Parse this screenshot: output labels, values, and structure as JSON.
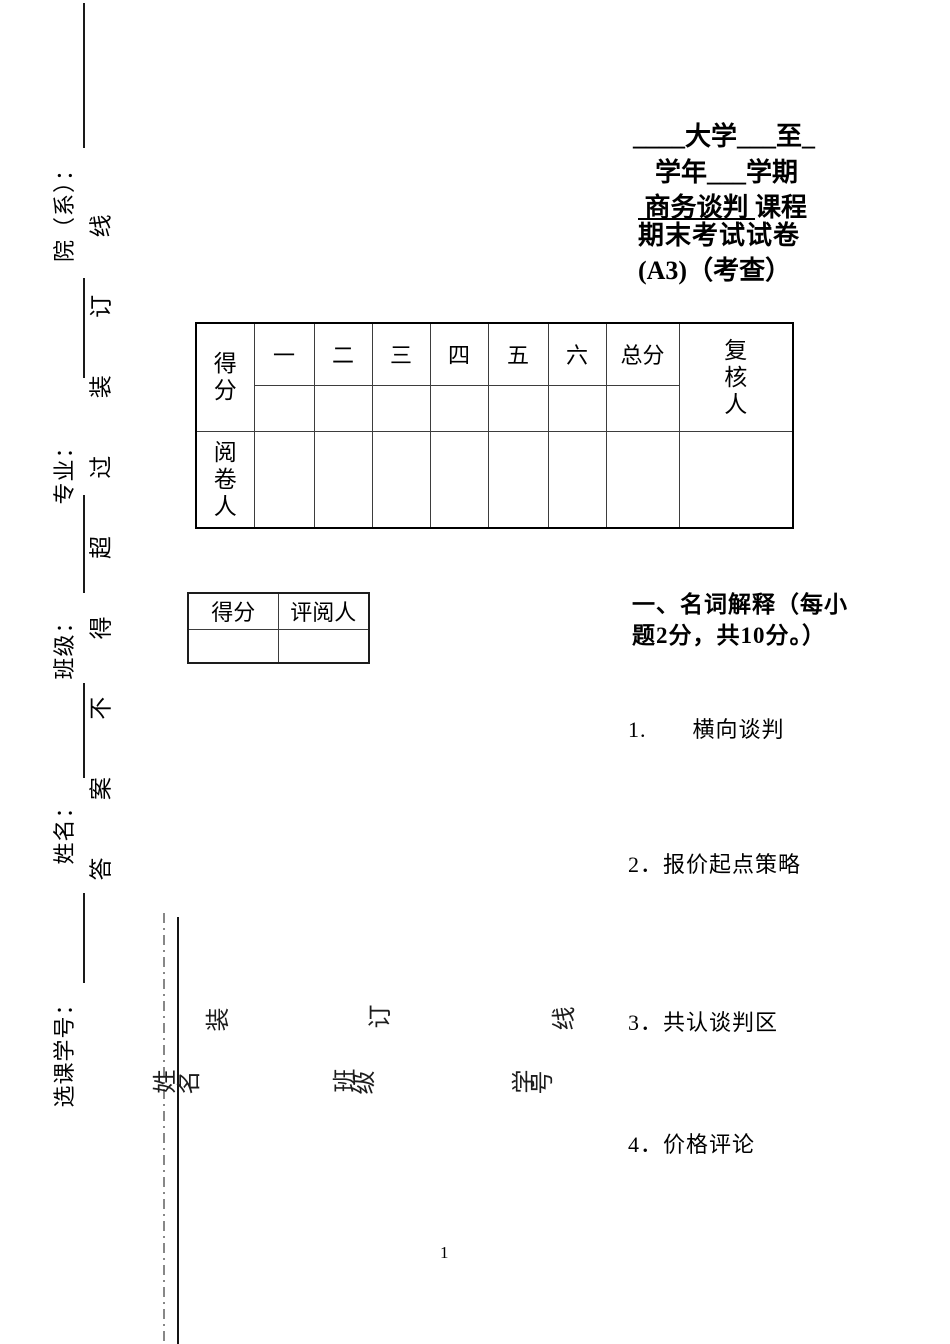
{
  "colors": {
    "text": "#000000",
    "background": "#ffffff"
  },
  "header": {
    "line1": "____大学___至_",
    "line2": "学年___学期",
    "course_name": " 商务谈判 ",
    "course_suffix": "课程",
    "line4": "期末考试试卷",
    "line5": "(A3)（考查）"
  },
  "score_table": {
    "score_label": "得分",
    "columns": [
      "一",
      "二",
      "三",
      "四",
      "五",
      "六",
      "总分"
    ],
    "review_label": "复核人",
    "grader_label": "阅卷人"
  },
  "sub_table": {
    "score_label": "得分",
    "marker_label": "评阅人"
  },
  "section_one": {
    "heading_line1": "一、名词解释（每小",
    "heading_line2": "题2分，共10分。）",
    "questions": [
      {
        "text": "1.　　横向谈判"
      },
      {
        "text": "2．报价起点策略"
      },
      {
        "text": "3．共认谈判区"
      },
      {
        "text": "4．价格评论"
      }
    ]
  },
  "left_margin": {
    "fields": [
      {
        "label": "院（系）："
      },
      {
        "label": "专业："
      },
      {
        "label": "班级："
      },
      {
        "label": "姓名："
      },
      {
        "label": "选课学号："
      }
    ],
    "binding_phrase": [
      "答",
      "案",
      "不",
      "得",
      "超",
      "过",
      "装",
      "订",
      "线"
    ]
  },
  "fold_strip": {
    "binding_chars": [
      "装",
      "订",
      "线"
    ],
    "field_chars": [
      "姓",
      "名",
      "班",
      "级",
      "学",
      "号"
    ]
  },
  "footer": {
    "page_number": "1"
  }
}
